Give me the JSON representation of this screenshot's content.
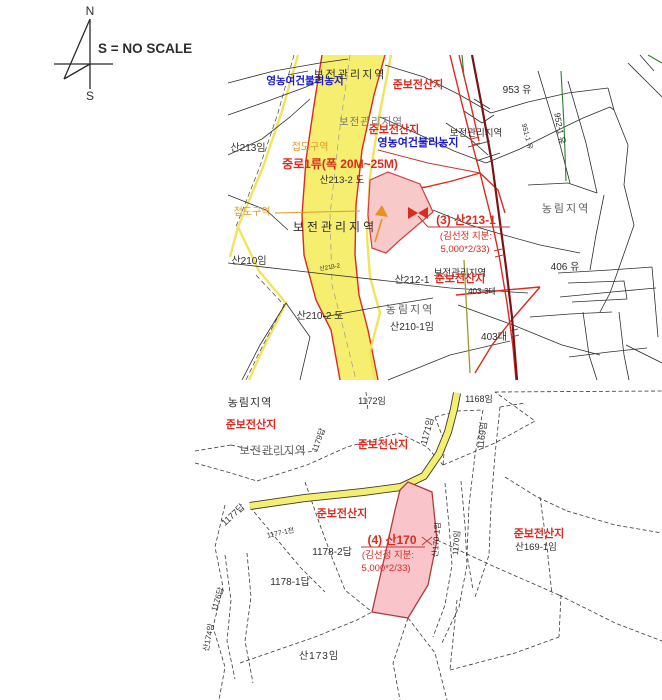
{
  "document": {
    "compass": {
      "north": "N",
      "south": "S"
    },
    "scale_note": "S = NO SCALE"
  },
  "colors": {
    "road_highlight": "#f5ee6e",
    "parcel_highlight": "#f8c9c9",
    "alert_text": "#d92b20",
    "farm_text": "#1a1acc",
    "zone_text": "#e09a30",
    "maroon_road": "#7a1414"
  },
  "map_top": {
    "labels": {
      "agri_zone_top": "영농여건불리농지",
      "mgmt_zone_top": "보전관리지역",
      "semi_forest_top": "준보전산지",
      "mgmt_zone_mid": "보전관리지역",
      "semi_forest_mid": "준보전산지",
      "agri_zone_mid": "영농여건불리농지",
      "mgmt_zone_right": "보전관리지역",
      "p953": "953 유",
      "p952_1": "952-1 유",
      "p951_1": "951-1 유",
      "san213": "산213임",
      "jeopdo_top": "접도구역",
      "road_class": "중로1류(폭 20M~25M)",
      "san213_2": "산213-2 도",
      "san213_2_small": "산213-2",
      "jeopdo_left": "접도구역",
      "mgmt_zone_low": "보전관리지역",
      "target_no": "(3) 산213-1",
      "target_owner": "(김선정 지분:",
      "target_share": "5,000*2/33)",
      "forest_zone_right": "농림지역",
      "p406": "406 유",
      "mgmt_zone_bottom": "보전관리지역",
      "semi_forest_low": "준보전산지",
      "san212_1": "산212-1",
      "p403_3": "403-3대",
      "forest_zone_bottom": "농림지역",
      "san210_1": "산210-1임",
      "san210_2": "산210-2 도",
      "san210": "산210임",
      "p403": "403대"
    }
  },
  "map_bottom": {
    "labels": {
      "forest_zone": "농림지역",
      "semi_forest_left": "준보전산지",
      "mgmt_zone": "보전관리지역",
      "p1179": "1179답",
      "p1172": "1172임",
      "semi_forest_mid": "준보전산지",
      "p1171": "1171임",
      "p1168": "1168임",
      "p1169": "1169임",
      "semi_forest_road": "준보전산지",
      "target_no": "(4) 산170",
      "target_owner": "(김선정 지분:",
      "target_share": "5,000*2/33)",
      "p1178_2": "1178-2답",
      "p1178_1": "1178-1답",
      "p1177": "1177답",
      "p1177_1": "1177-1전",
      "san170_1": "산170-1임",
      "p1170": "1170임",
      "semi_forest_right": "준보전산지",
      "san169_1": "산169-1임",
      "san173": "산173임",
      "san174": "산174임",
      "p1176": "1176답"
    }
  }
}
